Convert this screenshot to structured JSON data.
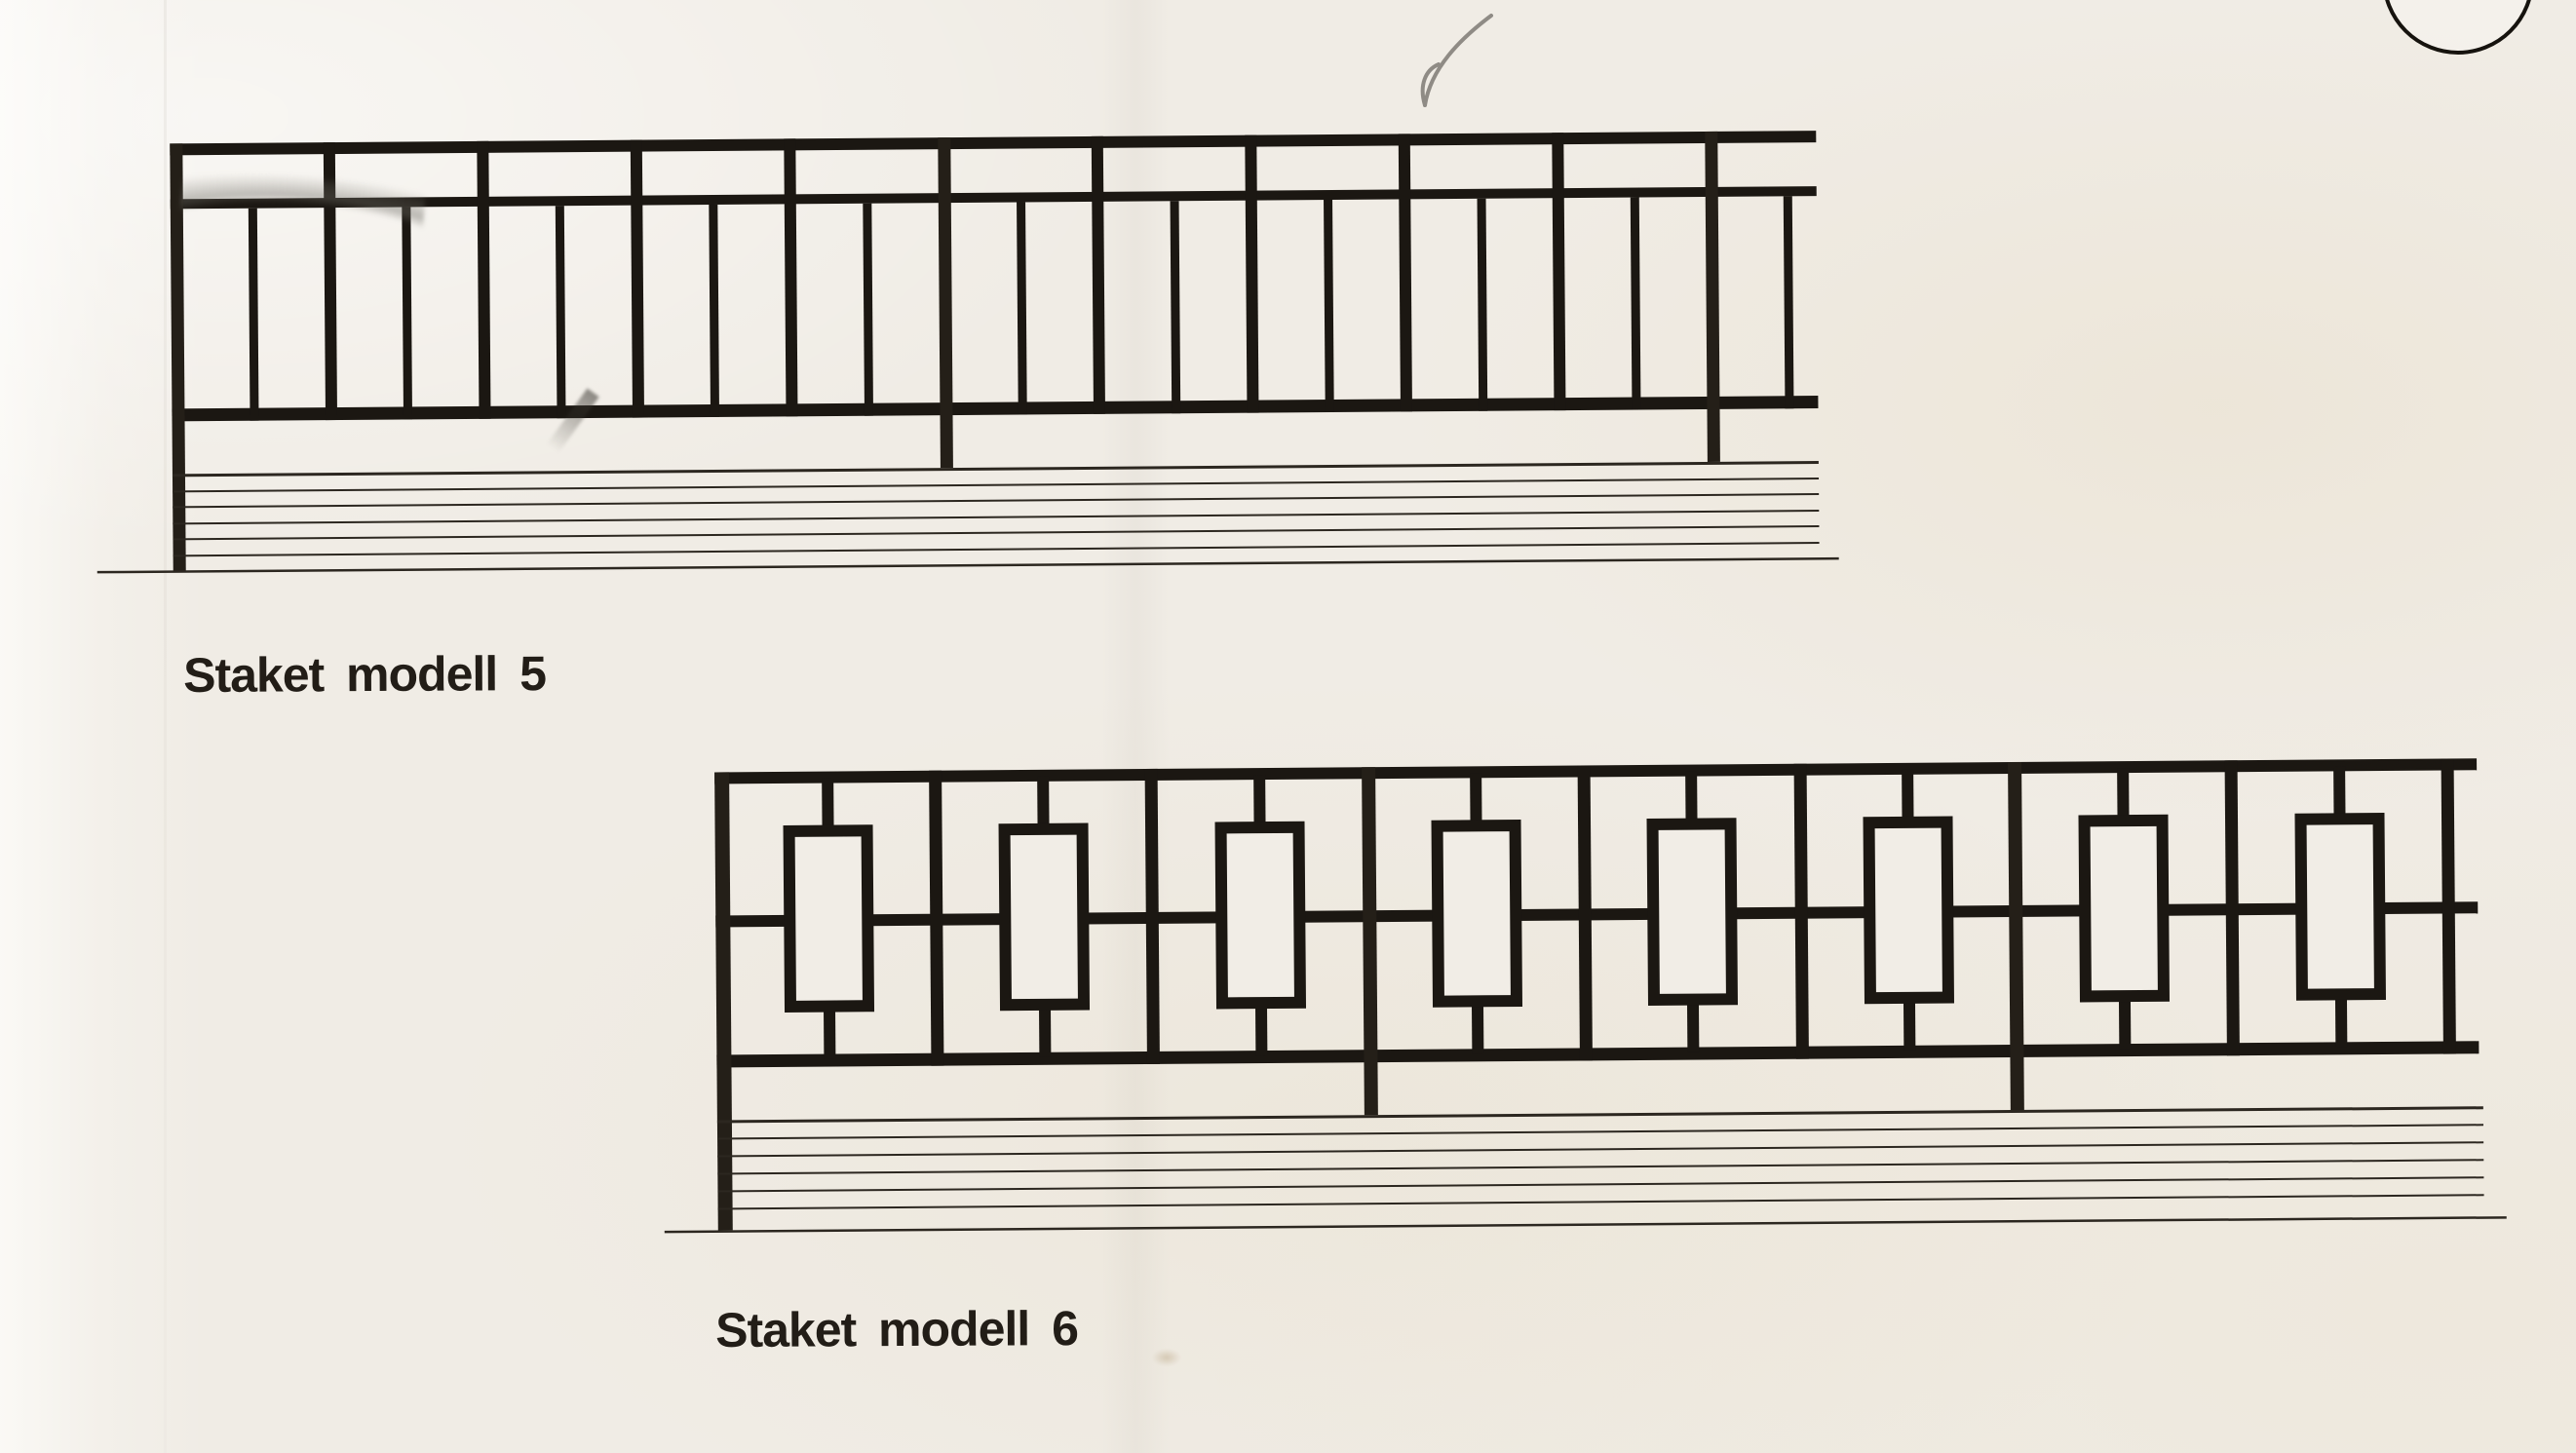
{
  "page": {
    "kind": "scanned fence catalog page",
    "paper_color": "#f0ece5",
    "ink_color": "#1b1712"
  },
  "figures": [
    {
      "caption": "Staket modell 5",
      "pattern": "vertical bar railing, double top rail",
      "posts": 3,
      "tall_bars": 8,
      "short_bars": 11,
      "ground_hatch_lines": 7
    },
    {
      "caption": "Staket modell 6",
      "pattern": "rectangle panels with centre stubs between full-height uprights",
      "posts": 3,
      "uprights": 6,
      "rectangles": 8,
      "ground_hatch_lines": 7
    }
  ],
  "marks": {
    "corner_circle": "partial circle at top right page corner",
    "pencil_smudges": 3
  }
}
